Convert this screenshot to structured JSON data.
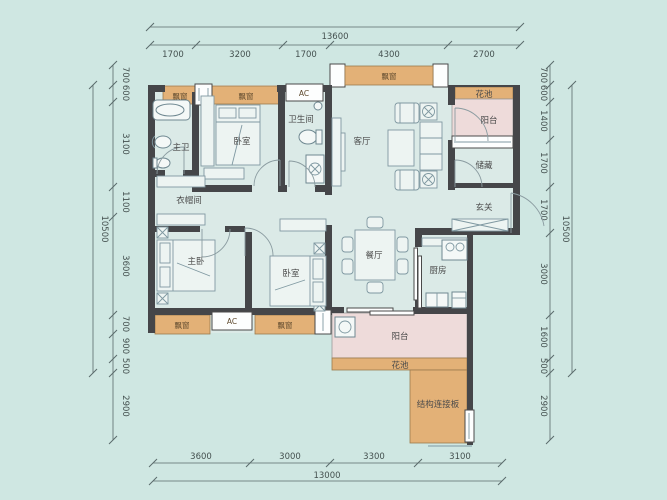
{
  "colors": {
    "background": "#cfe7e2",
    "wall": "#454649",
    "bay_window": "#e3b177",
    "balcony": "#eedbda",
    "room_fill": "#dbeae7",
    "furniture_line": "#7f98a1",
    "dimension_text": "#44504f"
  },
  "dims": {
    "top": {
      "total": "13600",
      "segs": [
        "1700",
        "3200",
        "1700",
        "4300",
        "2700"
      ]
    },
    "bottom": {
      "total": "13000",
      "segs": [
        "3600",
        "3000",
        "3300",
        "3100"
      ]
    },
    "left": {
      "total": "10500",
      "segs": [
        "700",
        "600",
        "3100",
        "1100",
        "3600",
        "700",
        "900",
        "500",
        "2900"
      ]
    },
    "right": {
      "total": "10500",
      "segs": [
        "700",
        "600",
        "1400",
        "1700",
        "1700",
        "3000",
        "1600",
        "500",
        "2900"
      ]
    }
  },
  "labels": {
    "master_bath": "主卫",
    "bedroom_top": "卧室",
    "bathroom": "卫生间",
    "living": "客厅",
    "flower_top": "花池",
    "balcony_top": "阳台",
    "storage": "储藏",
    "entry": "玄关",
    "cloakroom": "衣帽间",
    "master_bedroom": "主卧",
    "bedroom_bottom": "卧室",
    "dining": "餐厅",
    "kitchen": "厨房",
    "balcony_bottom": "阳台",
    "flower_bottom": "花池",
    "slab": "结构连接板",
    "bay_window": "飘窗",
    "ac": "AC"
  }
}
